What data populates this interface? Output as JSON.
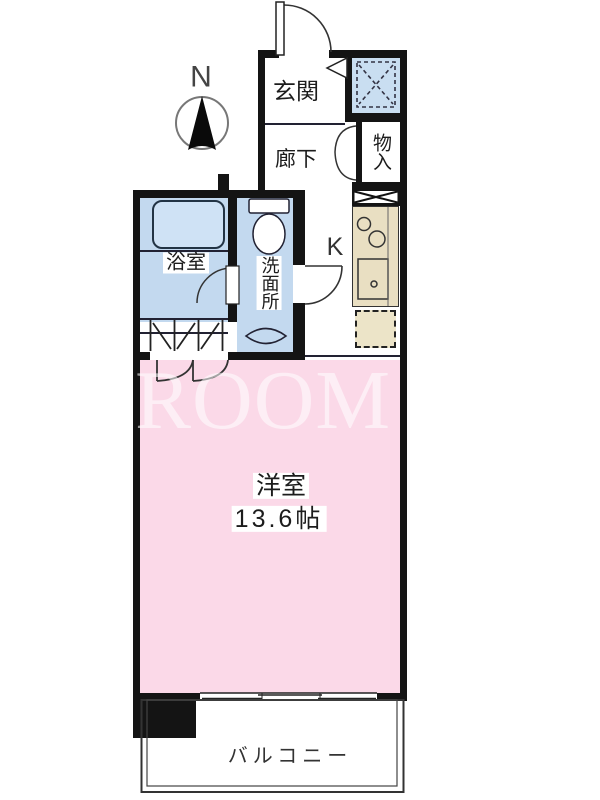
{
  "compass": {
    "north_label": "N"
  },
  "watermark": {
    "text": "ROOM COR"
  },
  "rooms": {
    "entrance": "玄関",
    "hallway": "廊下",
    "storage": "物入",
    "kitchen": "K",
    "bathroom": "浴室",
    "washroom": "洗面所",
    "western_room": "洋室",
    "western_room_size": "13.6帖",
    "balcony": "バルコニー"
  },
  "colors": {
    "wall": "#141414",
    "main_room_pink": "#fbd9e8",
    "wet_area_blue": "#c3d9ef",
    "bathtub_blue": "#cfe2f5",
    "kitchen_counter_tan": "#e9dfc2",
    "fridge_space_tan": "#ece4c8",
    "watermark_overlay": "rgba(255,255,255,0.56)"
  }
}
